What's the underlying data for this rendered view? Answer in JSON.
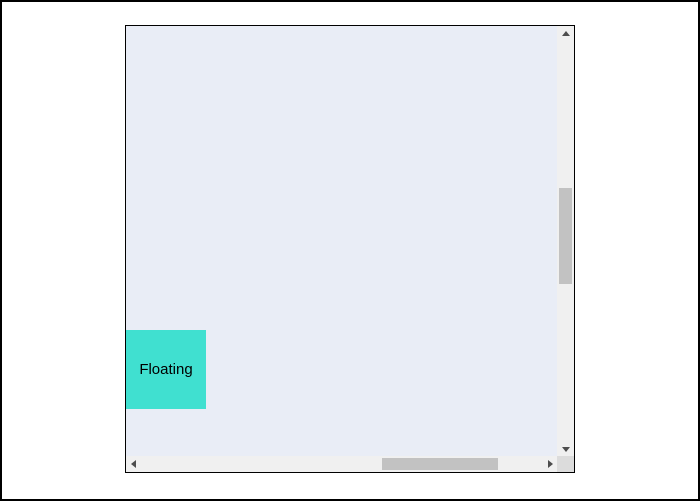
{
  "window": {
    "background": "#ffffff",
    "frame_color": "#000000"
  },
  "scroll_area": {
    "background": "#e9edf6",
    "border_color": "#000000",
    "scrollbars": {
      "track_color": "#f0f0f0",
      "thumb_color": "#c2c2c2",
      "corner_color": "#dcdcdc",
      "arrow_color": "#4d4d4d",
      "vertical_visible": true,
      "horizontal_visible": true
    }
  },
  "floating_widget": {
    "label": "Floating",
    "background": "#40e0d0",
    "text_color": "#000000"
  },
  "colors": {
    "--window-bg": "#ffffff",
    "--frame-color": "#000000",
    "--scrollarea-bg": "#e9edf6",
    "--scrollarea-border": "#000000",
    "--track": "#f0f0f0",
    "--thumb": "#c2c2c2",
    "--corner": "#dcdcdc",
    "--arrow": "#4d4d4d",
    "--floating-bg": "#40e0d0",
    "--floating-text": "#000000"
  }
}
